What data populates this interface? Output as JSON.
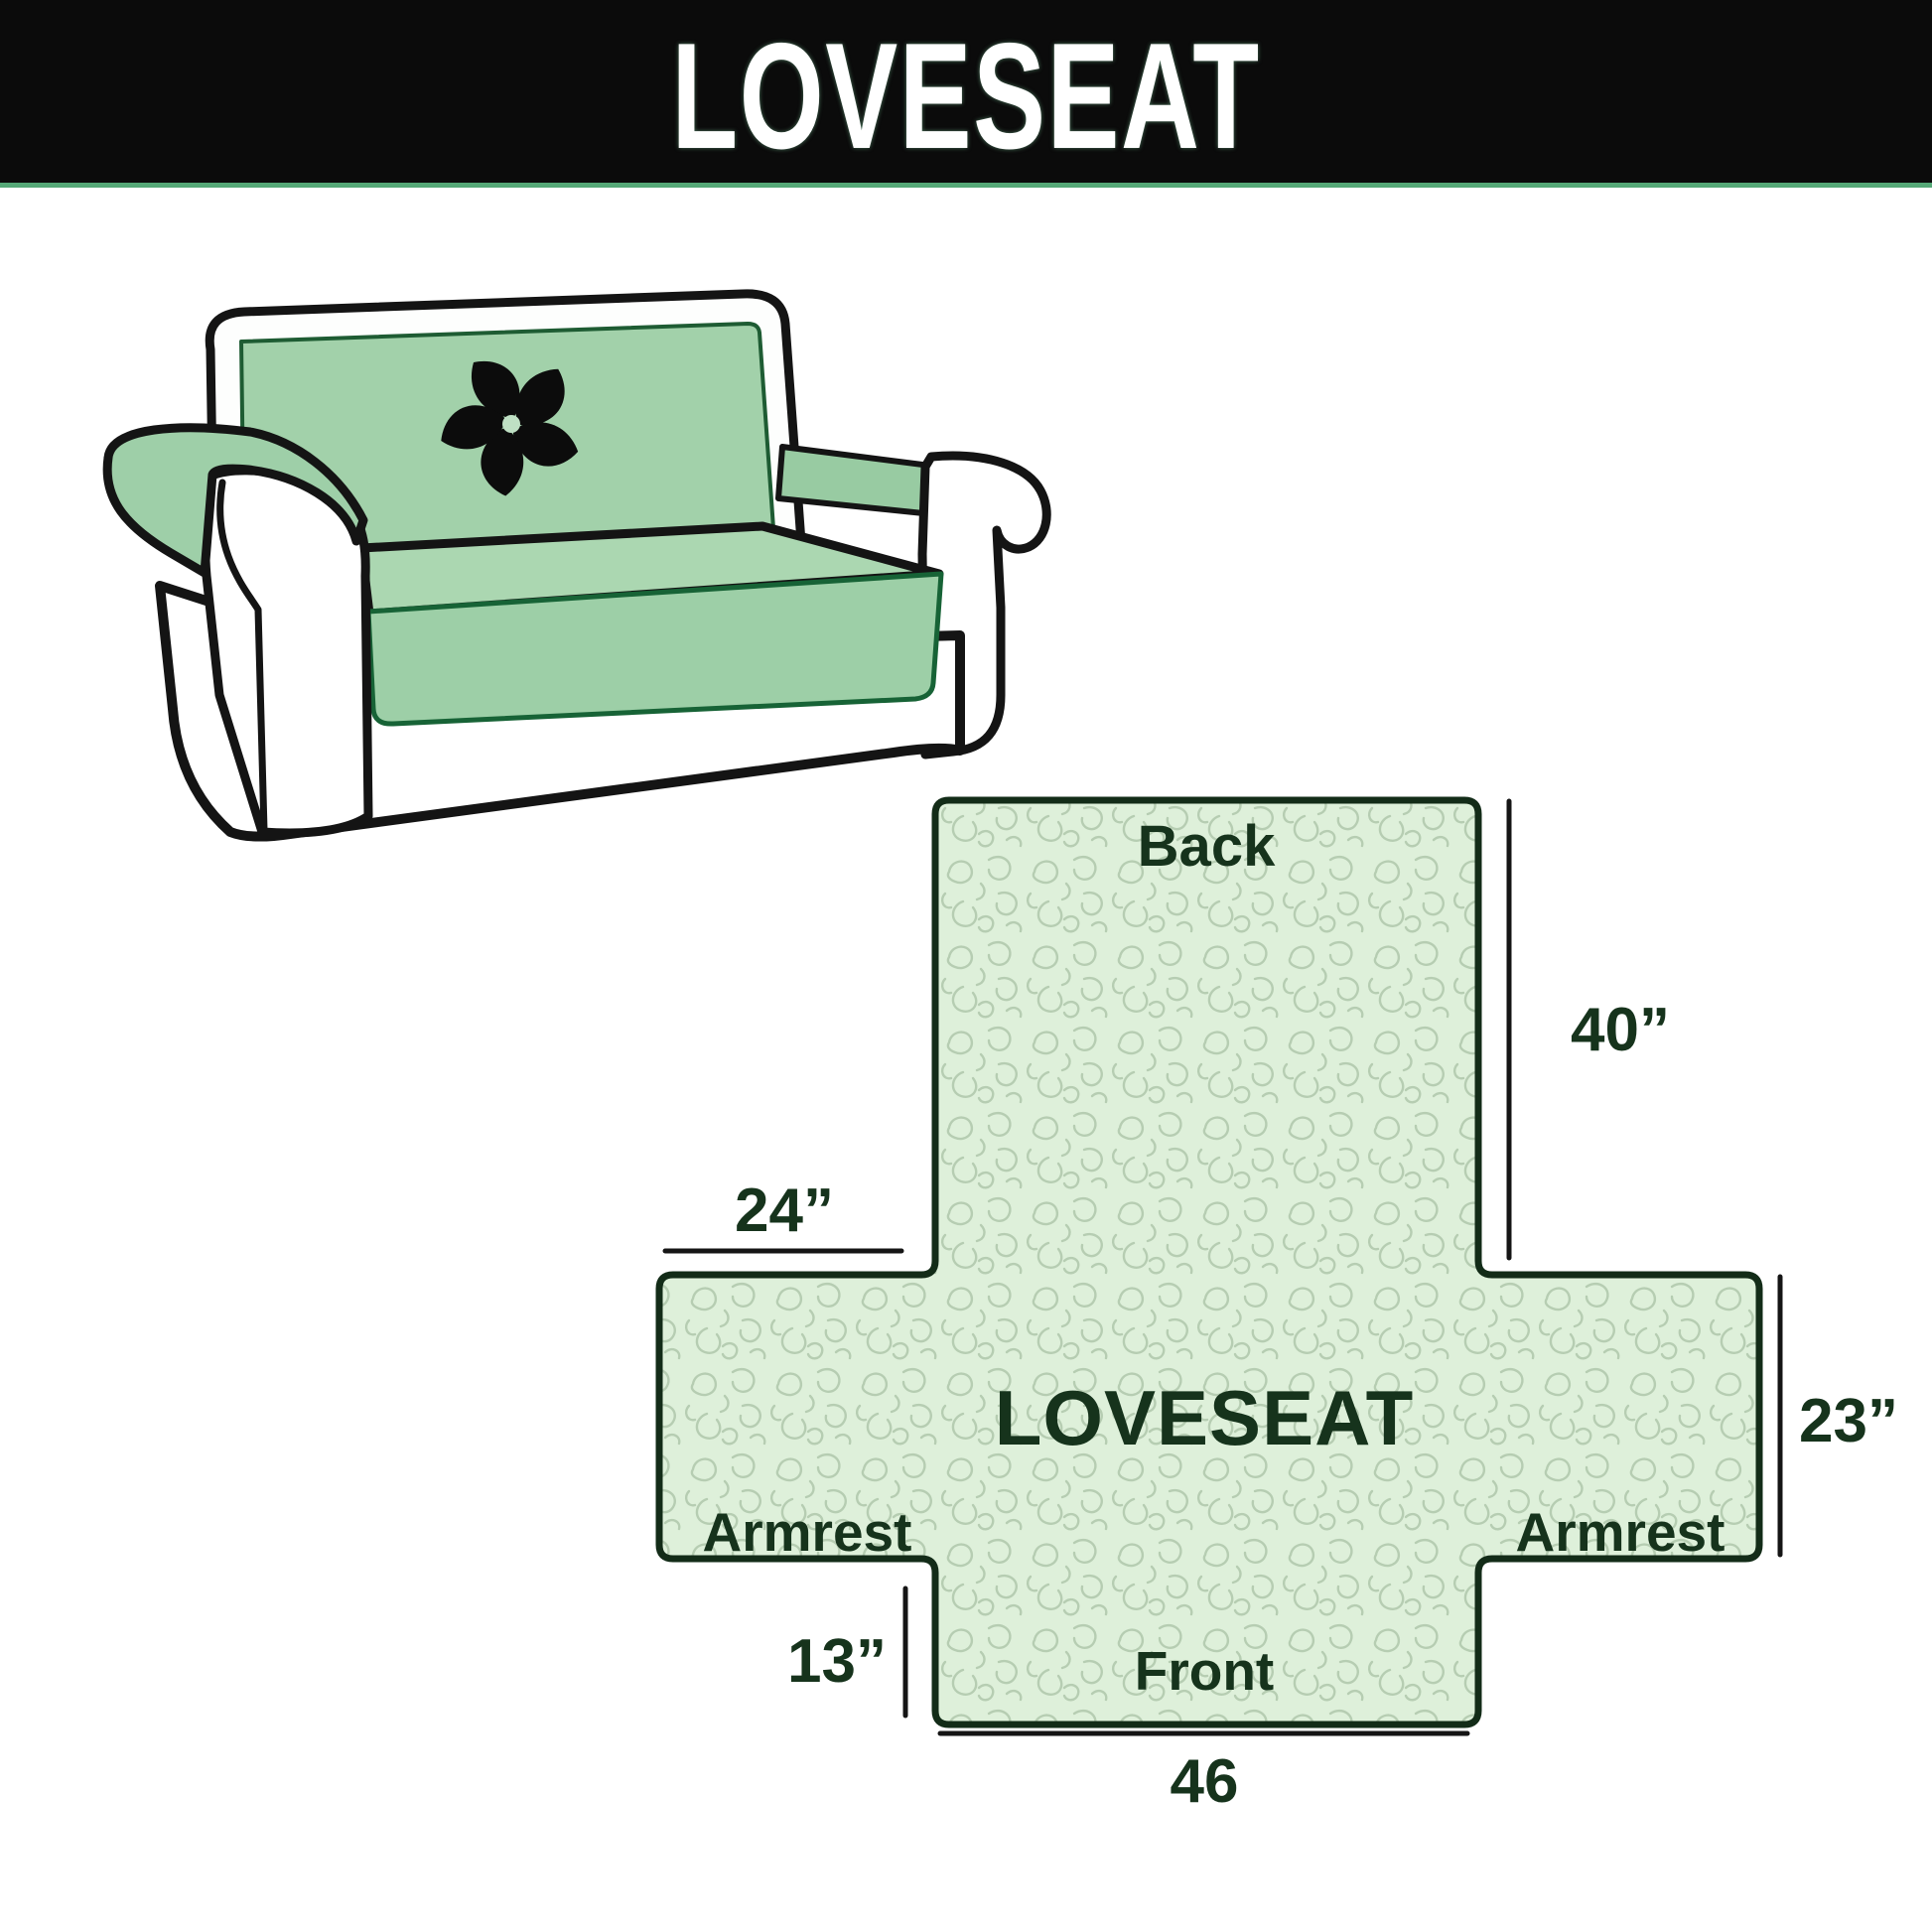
{
  "header": {
    "title": "LOVESEAT"
  },
  "diagram": {
    "center_label": "LOVESEAT",
    "back_label": "Back",
    "front_label": "Front",
    "armrest_left_label": "Armrest",
    "armrest_right_label": "Armrest",
    "dimensions": {
      "back_height": "40”",
      "armrest_top_width": "24”",
      "armrest_side_height": "23”",
      "front_drop": "13”",
      "front_width": "46"
    }
  },
  "colors": {
    "header_bg": "#0b0b0b",
    "header_text": "#ffffff",
    "header_underline": "#55a877",
    "cover_green": "#a3d2ab",
    "seat_green": "#abd7b1",
    "skirt_green": "#9dcfa7",
    "diagram_fill": "#def0da",
    "diagram_pattern": "#b6cdb2",
    "diagram_border": "#132c18",
    "label_text": "#16331c",
    "dimension_line": "#151515",
    "outline_black": "#141414"
  }
}
